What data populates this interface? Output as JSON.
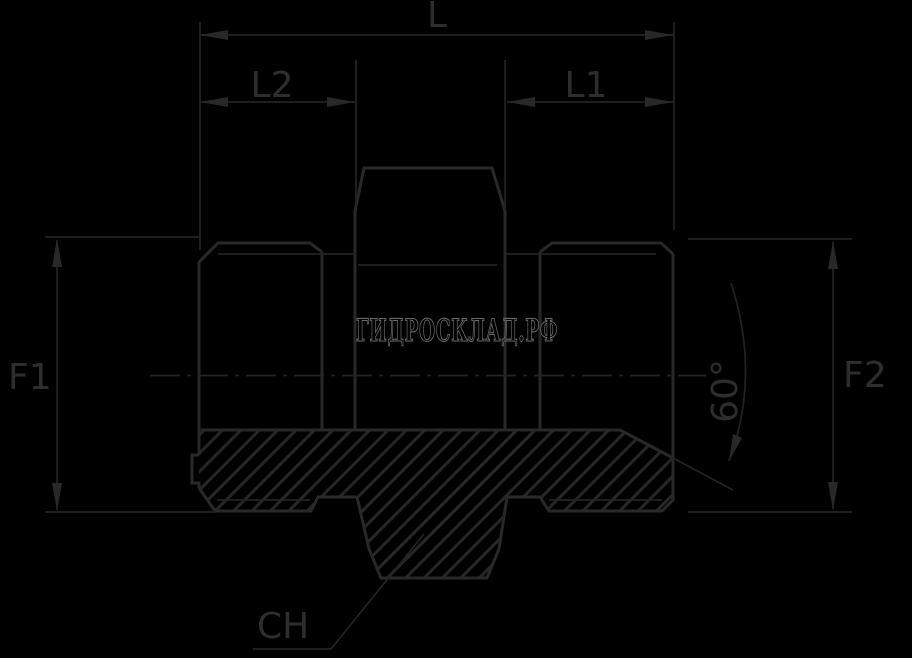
{
  "drawing": {
    "type": "technical-drawing-hydraulic-adapter",
    "watermark": "ГИДРОСКЛАД.РФ",
    "labels": {
      "length_total": "L",
      "length_left_thread": "L2",
      "length_right_thread": "L1",
      "diameter_left": "F1",
      "diameter_right": "F2",
      "cone_angle": "60°",
      "wrench_size": "CH"
    },
    "colors": {
      "background": "#000000",
      "line_ink": "#282828",
      "thin_ink": "#232323",
      "label_ink": "#2d2d2d",
      "watermark_ink": "#6b6b6b"
    }
  }
}
